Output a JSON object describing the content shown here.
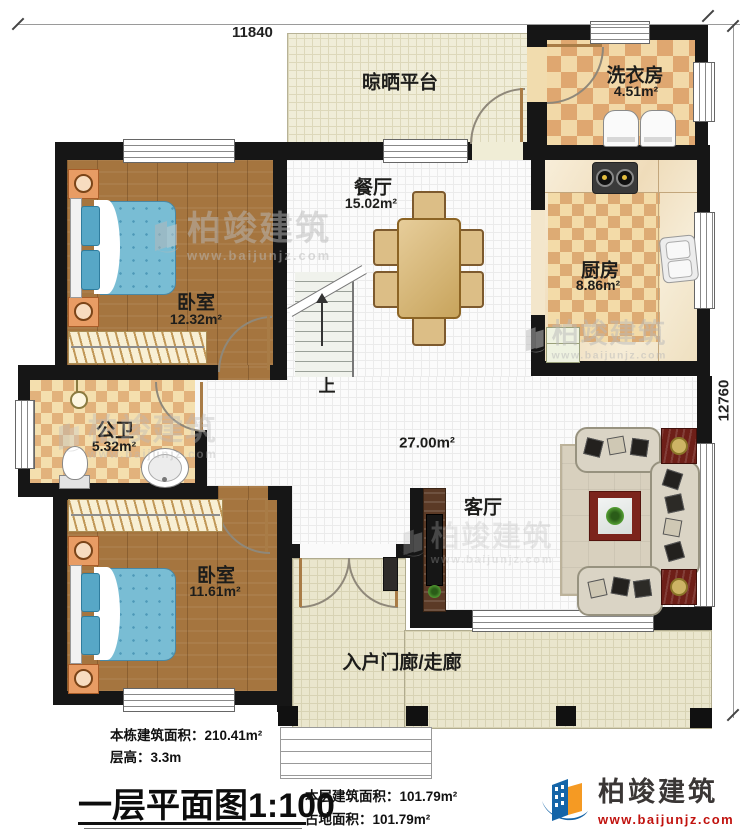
{
  "dimensions": {
    "width_mm": "11840",
    "depth_mm": "12760"
  },
  "rooms": [
    {
      "name": "晾晒平台",
      "area": ""
    },
    {
      "name": "洗衣房",
      "area": "4.51m²"
    },
    {
      "name": "餐厅",
      "area": "15.02m²"
    },
    {
      "name": "厨房",
      "area": "8.86m²"
    },
    {
      "name": "卧室",
      "area": "12.32m²"
    },
    {
      "name": "公卫",
      "area": "5.32m²"
    },
    {
      "name": "卧室",
      "area": "11.61m²"
    },
    {
      "name": "客厅",
      "area": "27.00m²"
    },
    {
      "name": "入户门廊/走廊",
      "area": ""
    }
  ],
  "stairs": {
    "up_label": "上"
  },
  "info": {
    "total_area_label": "本栋建筑面积：",
    "total_area": "210.41m²",
    "floor_height_label": "层高：",
    "floor_height": "3.3m",
    "title": "一层平面图",
    "scale": "1:100",
    "floor_area_label": "本层建筑面积：",
    "floor_area": "101.79m²",
    "land_area_label": "占地面积：",
    "land_area": "101.79m²"
  },
  "brand": {
    "name": "柏竣建筑",
    "url": "www.baijunjz.com"
  },
  "watermark": {
    "name": "柏竣建筑",
    "url": "www.baijunjz.com"
  },
  "colors": {
    "wall": "#161616",
    "brand_blue": "#1565a8",
    "brand_orange": "#f59a23",
    "brand_red": "#c1120e"
  }
}
